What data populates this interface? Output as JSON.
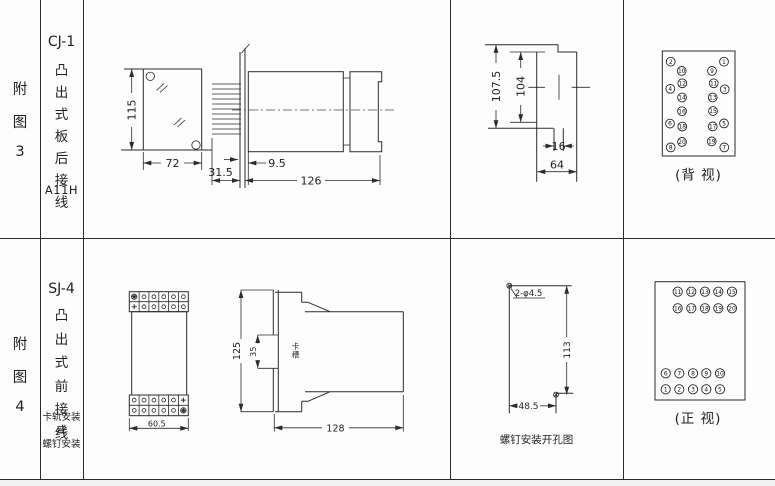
{
  "row1": {
    "fig_label": [
      "附",
      "图",
      "3"
    ],
    "model": "CJ-1",
    "wiring_type": [
      "凸",
      "出",
      "式",
      "板",
      "后",
      "接",
      "线"
    ],
    "code": "A11H",
    "plate_dims": {
      "height": "115",
      "width": "72"
    },
    "side_dims": {
      "pin_len": "31.5",
      "front_gap": "9.5",
      "body_len": "126"
    },
    "panel_dims": {
      "outer_h": "107.5",
      "inner_h": "104",
      "tab_w": "16",
      "body_w": "64"
    },
    "pin_view": {
      "caption": "(背 视)",
      "pins": [
        {
          "n": "2",
          "x": 670.7,
          "y": 61.7
        },
        {
          "n": "1",
          "x": 724.0,
          "y": 61.7
        },
        {
          "n": "10",
          "x": 681.7,
          "y": 70.9
        },
        {
          "n": "9",
          "x": 712.0,
          "y": 70.9
        },
        {
          "n": "12",
          "x": 682.3,
          "y": 83.3
        },
        {
          "n": "11",
          "x": 713.7,
          "y": 83.3
        },
        {
          "n": "4",
          "x": 670.3,
          "y": 88.8
        },
        {
          "n": "3",
          "x": 724.7,
          "y": 89.3
        },
        {
          "n": "14",
          "x": 682.0,
          "y": 97.5
        },
        {
          "n": "13",
          "x": 712.7,
          "y": 97.5
        },
        {
          "n": "16",
          "x": 682.0,
          "y": 111.2
        },
        {
          "n": "15",
          "x": 713.0,
          "y": 111.0
        },
        {
          "n": "6",
          "x": 670.0,
          "y": 123.6
        },
        {
          "n": "5",
          "x": 724.0,
          "y": 123.4
        },
        {
          "n": "18",
          "x": 682.3,
          "y": 126.6
        },
        {
          "n": "17",
          "x": 712.7,
          "y": 126.4
        },
        {
          "n": "20",
          "x": 682.0,
          "y": 141.9
        },
        {
          "n": "19",
          "x": 711.7,
          "y": 141.4
        },
        {
          "n": "8",
          "x": 670.7,
          "y": 147.4
        },
        {
          "n": "7",
          "x": 724.3,
          "y": 147.4
        }
      ]
    }
  },
  "row2": {
    "fig_label": [
      "附",
      "图",
      "4"
    ],
    "model": "SJ-4",
    "wiring_type": [
      "凸",
      "出",
      "式",
      "前",
      "接",
      "线"
    ],
    "mount_note": [
      "卡轨安装",
      "或",
      "螺钉安装"
    ],
    "front_dims": {
      "width": "60.5"
    },
    "side_dims": {
      "height": "125",
      "slot": "35",
      "slot_label": "卡槽",
      "length": "128"
    },
    "drill": {
      "holes": "2-φ4.5",
      "v": "113",
      "h": "48.5",
      "caption": "螺钉安装开孔图"
    },
    "pin_view": {
      "caption": "(正 视)",
      "pins": [
        {
          "n": "11",
          "x": 677.7,
          "y": 291.7
        },
        {
          "n": "12",
          "x": 691.3,
          "y": 291.7
        },
        {
          "n": "13",
          "x": 705.0,
          "y": 291.7
        },
        {
          "n": "14",
          "x": 718.3,
          "y": 291.7
        },
        {
          "n": "15",
          "x": 732.0,
          "y": 291.7
        },
        {
          "n": "16",
          "x": 677.7,
          "y": 308.3
        },
        {
          "n": "17",
          "x": 691.3,
          "y": 308.3
        },
        {
          "n": "18",
          "x": 705.0,
          "y": 308.3
        },
        {
          "n": "19",
          "x": 718.3,
          "y": 308.3
        },
        {
          "n": "20",
          "x": 732.0,
          "y": 308.3
        },
        {
          "n": "6",
          "x": 665.7,
          "y": 373.3
        },
        {
          "n": "7",
          "x": 679.3,
          "y": 373.3
        },
        {
          "n": "8",
          "x": 693.0,
          "y": 373.3
        },
        {
          "n": "9",
          "x": 706.3,
          "y": 373.3
        },
        {
          "n": "10",
          "x": 720.0,
          "y": 373.3
        },
        {
          "n": "1",
          "x": 665.7,
          "y": 389.3
        },
        {
          "n": "2",
          "x": 679.3,
          "y": 389.3
        },
        {
          "n": "3",
          "x": 693.0,
          "y": 389.3
        },
        {
          "n": "4",
          "x": 706.3,
          "y": 389.3
        },
        {
          "n": "5",
          "x": 720.0,
          "y": 389.3
        }
      ]
    }
  }
}
